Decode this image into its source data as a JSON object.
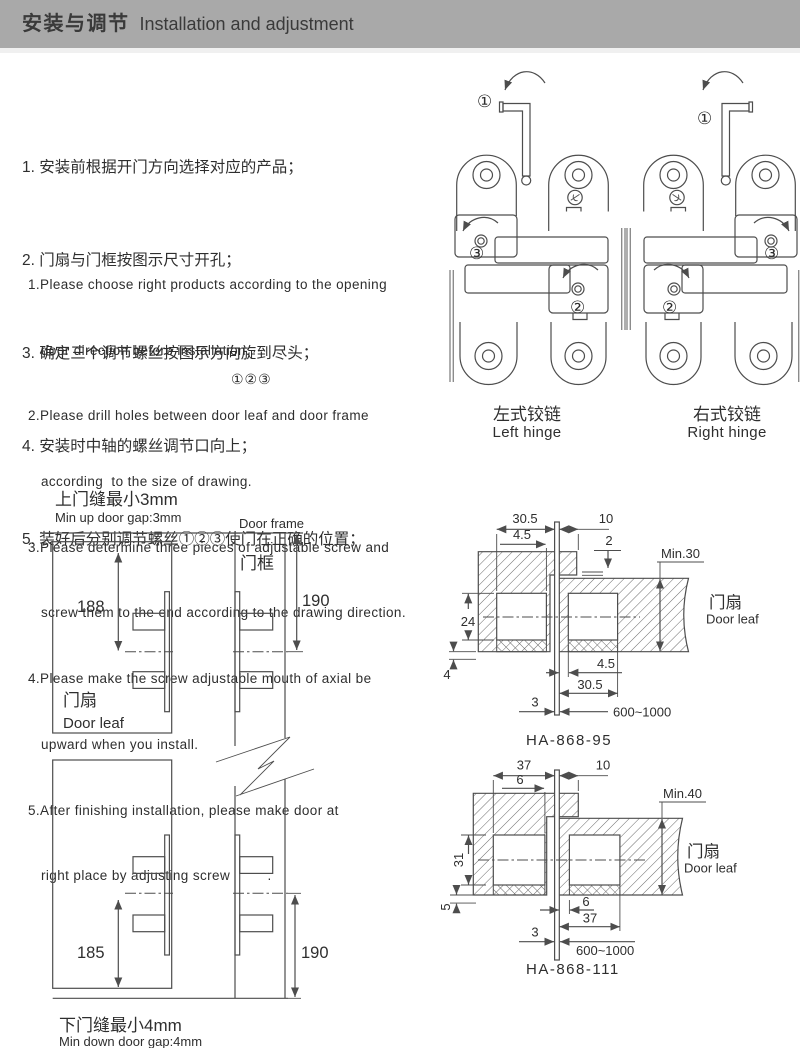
{
  "header": {
    "title_zh": "安装与调节",
    "title_en": "Installation and adjustment"
  },
  "instructions_zh": [
    "1. 安装前根据开门方向选择对应的产品；",
    "2. 门扇与门框按图示尺寸开孔；",
    "3. 确定三个调节螺丝按图示方向旋到尽头；",
    "4. 安装时中轴的螺丝调节口向上；",
    "5. 装好后分别调节螺丝①②③使门在正确的位置；"
  ],
  "instructions_en": {
    "lines": [
      "1.Please choose right products according to the opening",
      "door direction before installation.",
      "2.Please drill holes between door leaf and door frame",
      "according  to the size of drawing.",
      "3.Please determine three pieces of adjustable screw and",
      "screw them to the end according to the drawing direction.",
      "4.Please make the screw adjustable mouth of axial be",
      "upward when you install.",
      "5.After finishing installation, please make door at",
      "right place by adjusting screw         ."
    ],
    "floating_circled": "①②③"
  },
  "hinges": {
    "left": {
      "label_zh": "左式铰链",
      "label_en": "Left hinge",
      "callout_1": "①",
      "callout_2": "②",
      "callout_3": "③"
    },
    "right": {
      "label_zh": "右式铰链",
      "label_en": "Right hinge",
      "callout_1": "①",
      "callout_2": "②",
      "callout_3": "③"
    },
    "logo_icon": "brand-mark"
  },
  "gap_drawing": {
    "title_top_zh": "上门缝最小3mm",
    "title_top_en": "Min up door gap:3mm",
    "door_frame_en": "Door frame",
    "door_frame_zh": "门框",
    "door_leaf_zh": "门扇",
    "door_leaf_en": "Door leaf",
    "dim_leaf_top": "188",
    "dim_frame_top": "190",
    "dim_leaf_bottom": "185",
    "dim_frame_bottom": "190",
    "title_bottom_zh": "下门缝最小4mm",
    "title_bottom_en": "Min down door gap:4mm"
  },
  "cross_sections": [
    {
      "model": "HA-868-95",
      "door_leaf_zh": "门扇",
      "door_leaf_en": "Door leaf",
      "top_width": "30.5",
      "top_inner": "4.5",
      "top_gap_offset": "10",
      "plate": "2",
      "leaf_min": "Min.30",
      "pocket_height": "24",
      "frame_offset": "4",
      "bottom_inner": "4.5",
      "bottom_width": "30.5",
      "gap": "3",
      "door_width": "600~1000"
    },
    {
      "model": "HA-868-111",
      "door_leaf_zh": "门扇",
      "door_leaf_en": "Door leaf",
      "top_width": "37",
      "top_inner": "6",
      "top_gap_offset": "10",
      "leaf_min": "Min.40",
      "pocket_height": "31",
      "frame_offset": "5",
      "bottom_inner": "6",
      "bottom_width": "37",
      "gap": "3",
      "door_width": "600~1000"
    }
  ]
}
